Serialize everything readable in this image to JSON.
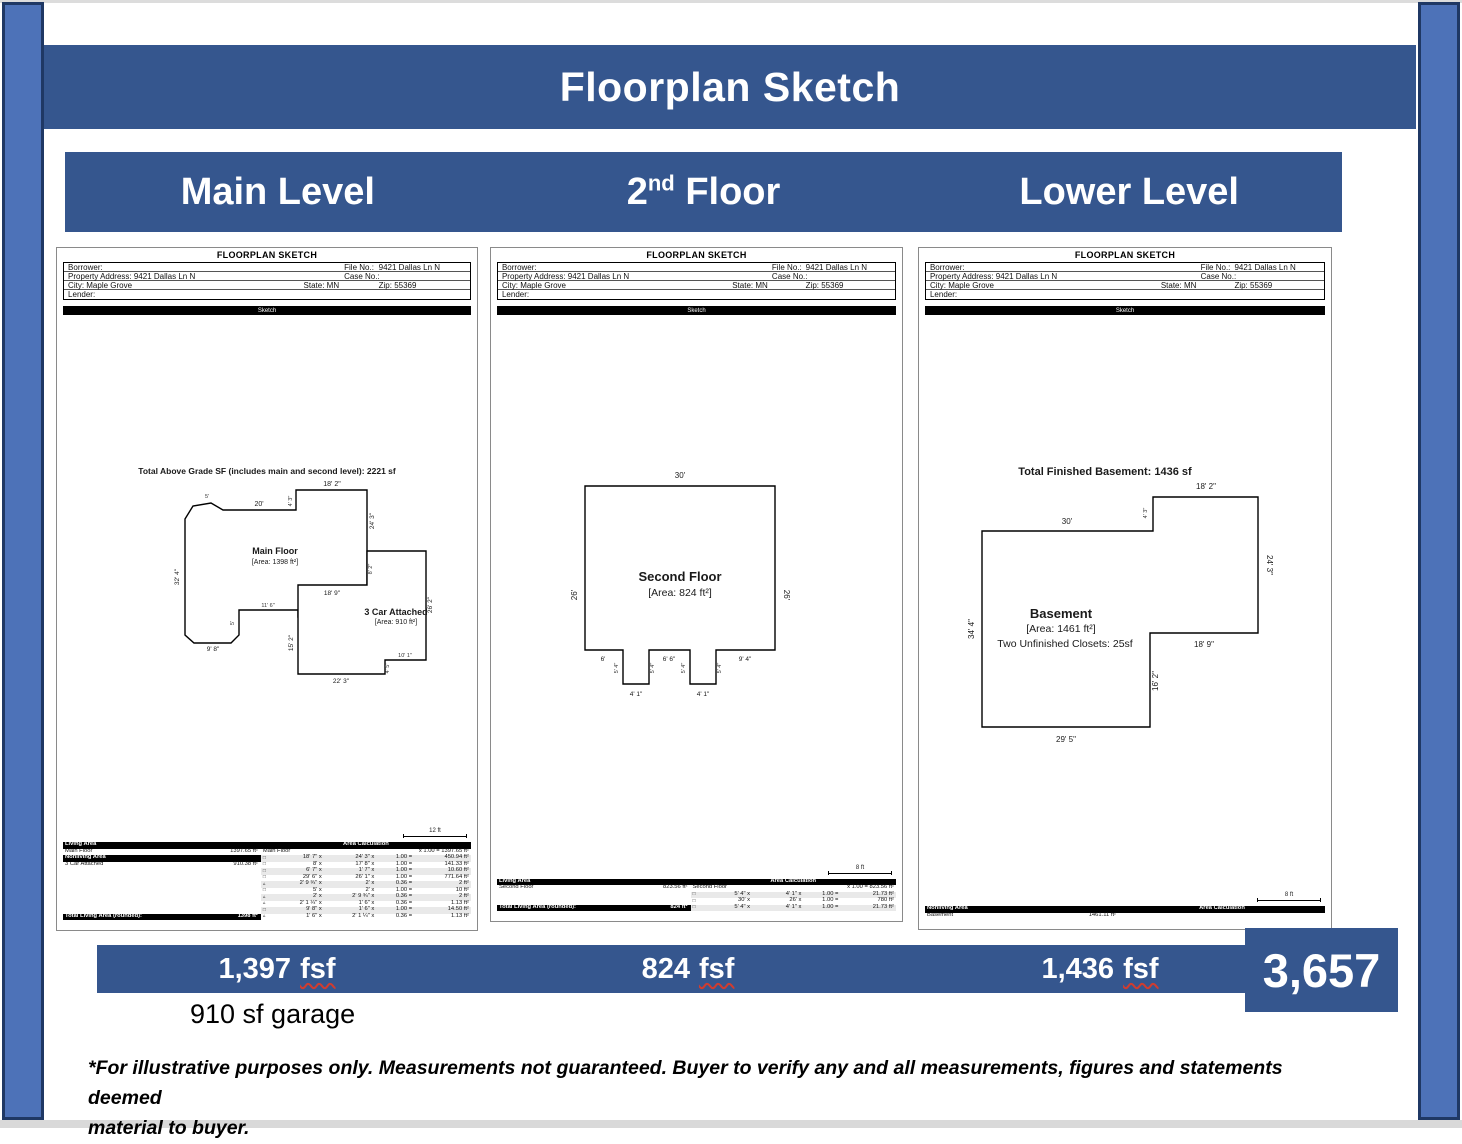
{
  "page": {
    "title": "Floorplan Sketch"
  },
  "levels_bar": {
    "main": "Main Level",
    "second_pre": "2",
    "second_sup": "nd",
    "second_post": " Floor",
    "lower": "Lower Level"
  },
  "colors": {
    "bar_blue": "#35568e",
    "strip_blue": "#4d72b8",
    "strip_border": "#1f3864",
    "squiggle_red": "#d03c2f"
  },
  "panels": {
    "main": {
      "doc": {
        "title": "FLOORPLAN SKETCH",
        "borrower": "Borrower:",
        "file_no": "File No.:",
        "file_no_value": "9421 Dallas Ln N",
        "property": "Property Address: 9421 Dallas Ln N",
        "case_no": "Case No.:",
        "city": "City: Maple Grove",
        "state": "State: MN",
        "zip": "Zip: 55369",
        "lender": "Lender:",
        "sketch_bar": "Sketch"
      },
      "sketch": {
        "title": "Total Above Grade SF (includes main and second level): 2221 sf",
        "main_floor_name": "Main Floor",
        "main_floor_area": "[Area: 1398 ft²]",
        "garage_name": "3 Car Attached",
        "garage_area": "[Area: 910 ft²]",
        "labels": {
          "d18_2": "18' 2\"",
          "d4_3": "4' 3\"",
          "d20": "20'",
          "d5": "5'",
          "d24_3": "24' 3\"",
          "d32_4": "32' 4\"",
          "d18_9": "18' 9\"",
          "d8_2": "8' 2\"",
          "d26_2": "26' 2\"",
          "d11_6": "11' 6\"",
          "d5b": "5'",
          "d15_2": "15' 2\"",
          "d9_8": "9' 8\"",
          "d22_3": "22' 3\"",
          "d4_5": "4' 5\"",
          "d10_1": "10' 1\""
        }
      },
      "scale": "12 ft",
      "table": {
        "living_area_hdr": "Living Area",
        "area_calc_hdr": "Area Calculation",
        "main_floor": "Main Floor",
        "main_floor_val": "1397.65 ft²",
        "calc_first": "x 1.00 = 1397.65 ft²",
        "nonliving_hdr": "Nonliving Area",
        "garage": "3 Car Attached",
        "garage_val": "910.38 ft²",
        "total_label": "Total Living Area (rounded):",
        "total_val": "1398 ft²",
        "calc_rows": [
          {
            "g": "□",
            "a": "18' 7\" x",
            "b": "24' 3\" x",
            "c": "1.00 =",
            "d": "450.94 ft²"
          },
          {
            "g": "□",
            "a": "8' x",
            "b": "17' 8\" x",
            "c": "1.00 =",
            "d": "141.33 ft²"
          },
          {
            "g": "□",
            "a": "6' 7\" x",
            "b": "1' 7\" x",
            "c": "1.00 =",
            "d": "10.60 ft²"
          },
          {
            "g": "□",
            "a": "29' 6\" x",
            "b": "26' 1\" x",
            "c": "1.00 =",
            "d": "771.64 ft²"
          },
          {
            "g": "▵",
            "a": "2' 9 ¾\" x",
            "b": "2' x",
            "c": "0.36 =",
            "d": "2 ft²"
          },
          {
            "g": "□",
            "a": "5' x",
            "b": "2' x",
            "c": "1.00 =",
            "d": "10 ft²"
          },
          {
            "g": "▵",
            "a": "2' x",
            "b": "2' 9 ¾\" x",
            "c": "0.36 =",
            "d": "2 ft²"
          },
          {
            "g": "▵",
            "a": "2' 1 ¼\" x",
            "b": "1' 6\" x",
            "c": "0.36 =",
            "d": "1.13 ft²"
          },
          {
            "g": "□",
            "a": "9' 8\" x",
            "b": "1' 6\" x",
            "c": "1.00 =",
            "d": "14.50 ft²"
          },
          {
            "g": "▵",
            "a": "1' 6\" x",
            "b": "2' 1 ¼\" x",
            "c": "0.36 =",
            "d": "1.13 ft²"
          }
        ]
      }
    },
    "second": {
      "doc": {
        "title": "FLOORPLAN SKETCH",
        "borrower": "Borrower:",
        "file_no": "File No.:",
        "file_no_value": "9421 Dallas Ln N",
        "property": "Property Address: 9421 Dallas Ln N",
        "case_no": "Case No.:",
        "city": "City: Maple Grove",
        "state": "State: MN",
        "zip": "Zip: 55369",
        "lender": "Lender:",
        "sketch_bar": "Sketch"
      },
      "sketch": {
        "name": "Second Floor",
        "area": "[Area: 824 ft²]",
        "labels": {
          "d30": "30'",
          "d26l": "26'",
          "d26r": "26'",
          "d6": "6'",
          "d6_6": "6' 6\"",
          "d9_4": "9' 4\"",
          "d4_1a": "4' 1\"",
          "d4_1b": "4' 1\"",
          "d5_4a": "5' 4\"",
          "d5_4b": "5' 4\"",
          "d5_4c": "5' 4\"",
          "d5_4d": "5' 4\""
        }
      },
      "scale": "8 ft",
      "table": {
        "living_area_hdr": "Living Area",
        "area_calc_hdr": "Area Calculation",
        "second_floor": "Second Floor",
        "second_floor_val": "823.56 ft²",
        "calc_first": "x 1.00 = 823.56 ft²",
        "total_label": "Total Living Area (rounded):",
        "total_val": "824 ft²",
        "calc_rows": [
          {
            "g": "□",
            "a": "5' 4\" x",
            "b": "4' 1\" x",
            "c": "1.00 =",
            "d": "21.73 ft²"
          },
          {
            "g": "□",
            "a": "30' x",
            "b": "26' x",
            "c": "1.00 =",
            "d": "780 ft²"
          },
          {
            "g": "□",
            "a": "5' 4\" x",
            "b": "4' 1\" x",
            "c": "1.00 =",
            "d": "21.73 ft²"
          }
        ]
      }
    },
    "lower": {
      "doc": {
        "title": "FLOORPLAN SKETCH",
        "borrower": "Borrower:",
        "file_no": "File No.:",
        "file_no_value": "9421 Dallas Ln N",
        "property": "Property Address: 9421 Dallas Ln N",
        "case_no": "Case No.:",
        "city": "City: Maple Grove",
        "state": "State: MN",
        "zip": "Zip: 55369",
        "lender": "Lender:",
        "sketch_bar": "Sketch"
      },
      "sketch": {
        "title": "Total Finished Basement: 1436 sf",
        "name": "Basement",
        "area": "[Area: 1461 ft²]",
        "closets": "Two Unfinished Closets: 25sf",
        "labels": {
          "d18_2": "18' 2\"",
          "d30": "30'",
          "d4_3": "4' 3\"",
          "d24_3": "24' 3\"",
          "d34_4": "34' 4\"",
          "d18_9": "18' 9\"",
          "d16_2": "16' 2\"",
          "d29_5": "29' 5\""
        }
      },
      "scale": "8 ft",
      "table": {
        "nonliving_hdr": "Nonliving Area",
        "area_calc_hdr": "Area Calculation",
        "basement": "Basement",
        "basement_val": "1461.11 ft²"
      }
    }
  },
  "summary": {
    "items": [
      {
        "value": "1,397",
        "unit": "fsf"
      },
      {
        "value": "824",
        "unit": "fsf"
      },
      {
        "value": "1,436",
        "unit": "fsf"
      }
    ],
    "total": "3,657",
    "garage_note": "910 sf garage",
    "disclaimer_line1": "*For illustrative purposes only. Measurements not guaranteed.  Buyer to verify any and all measurements, figures and statements deemed",
    "disclaimer_line2": "material to buyer."
  }
}
